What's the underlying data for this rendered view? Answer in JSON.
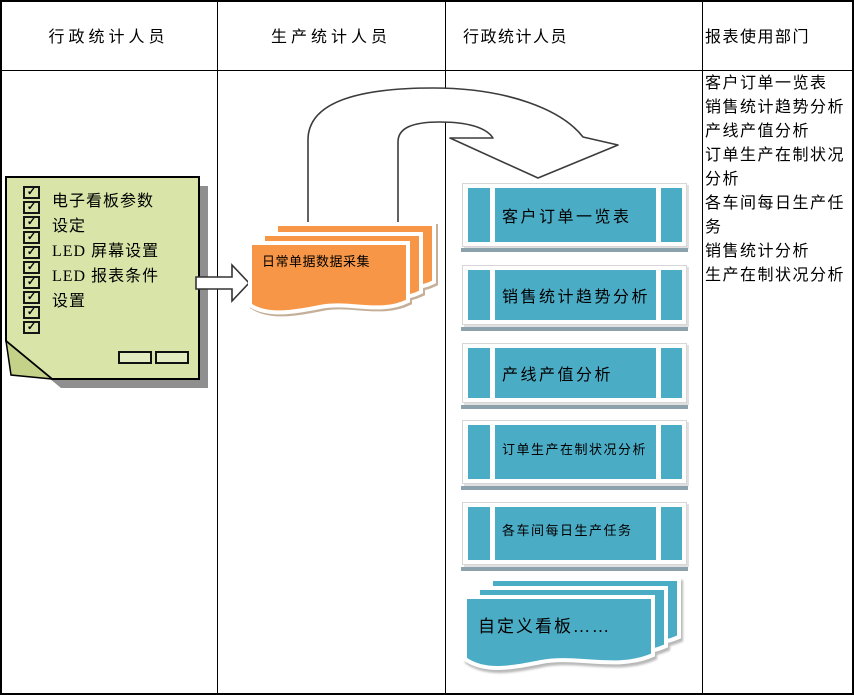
{
  "lanes": [
    {
      "label": "行政统计人员"
    },
    {
      "label": "生产统计人员"
    },
    {
      "label": "行政统计人员"
    },
    {
      "label": "报表使用部门"
    }
  ],
  "note": {
    "checkbox_count": 10,
    "lines": [
      "电子看板参数",
      "设定",
      "LED 屏幕设置",
      "LED 报表条件",
      "设置"
    ]
  },
  "icons": {
    "check": "✓"
  },
  "daily_doc": {
    "label": "日常单据数据采集"
  },
  "screens": [
    {
      "label": "客户订单一览表"
    },
    {
      "label": "销售统计趋势分析"
    },
    {
      "label": "产线产值分析"
    },
    {
      "label": "订单生产在制状况分析"
    },
    {
      "label": "各车间每日生产任务"
    }
  ],
  "custom_board": {
    "label": "自定义看板……"
  },
  "report_list": {
    "items": [
      "客户订单一览表",
      "销售统计趋势分析",
      "产线产值分析",
      "订单生产在制状况分析",
      "各车间每日生产任务",
      "销售统计分析",
      "生产在制状况分析"
    ]
  },
  "colors": {
    "teal": "#4BACC6",
    "orange": "#F79646",
    "note_green": "#D8E4A8",
    "underline_bar": "#8BA2AD"
  }
}
